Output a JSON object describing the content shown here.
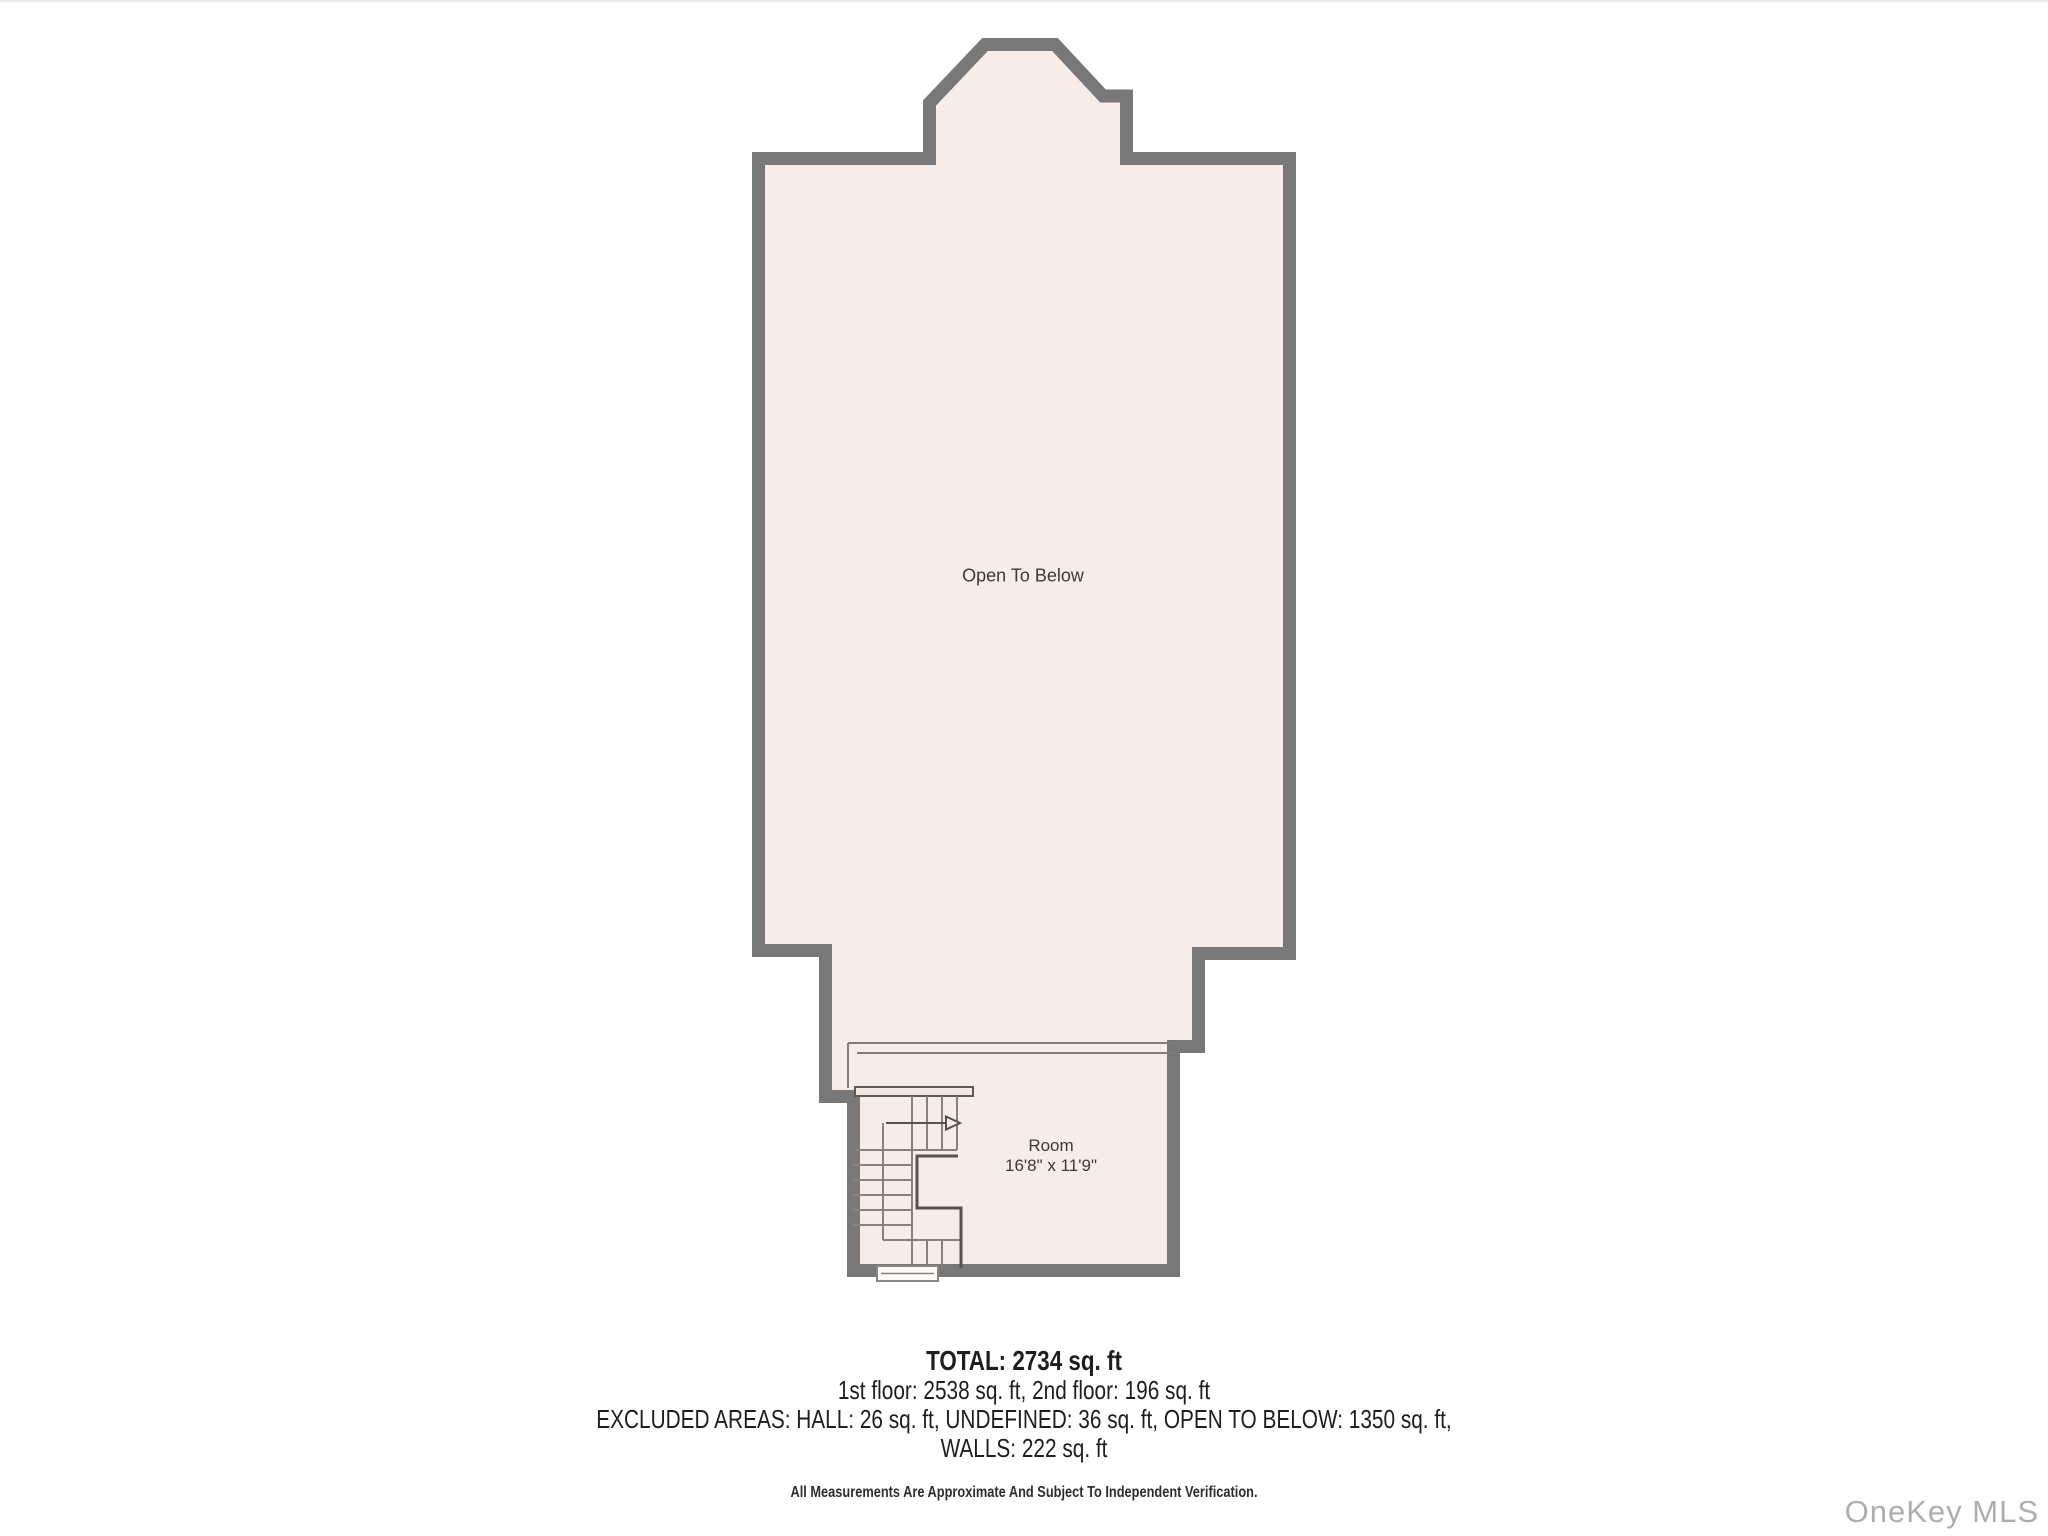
{
  "page": {
    "background": "#ffffff"
  },
  "floor_plan": {
    "wall_color": "#787878",
    "floor_color": "#f6ede8",
    "stair_line_color": "#857c73",
    "open_area_label": "Open To Below",
    "room": {
      "name": "Room",
      "dimensions": "16'8\" x 11'9\""
    }
  },
  "summary": {
    "total": "TOTAL: 2734 sq. ft",
    "floors_line": "1st floor: 2538 sq. ft, 2nd floor: 196 sq. ft",
    "excluded_line1": "EXCLUDED AREAS: HALL: 26 sq. ft, UNDEFINED: 36 sq. ft, OPEN TO BELOW: 1350 sq. ft,",
    "excluded_line2": "WALLS: 222 sq. ft",
    "disclaimer": "All Measurements Are Approximate And Subject To Independent Verification."
  },
  "watermark": {
    "label": "OneKey MLS",
    "color": "#b0aeac"
  }
}
